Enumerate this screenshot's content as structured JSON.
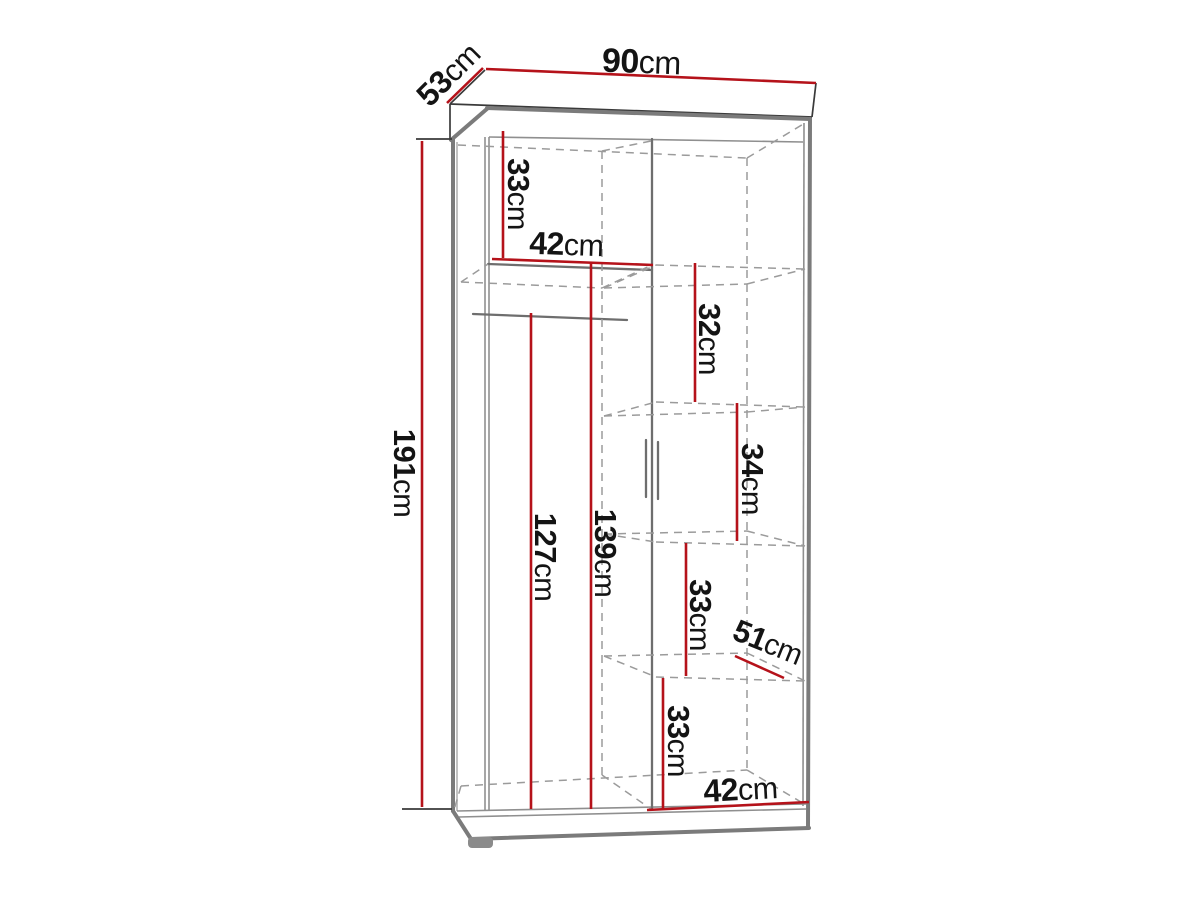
{
  "diagram": {
    "type": "furniture-dimension-drawing",
    "subject": "two-door wardrobe with left hanging section and right shelf column",
    "unit": "cm",
    "colors": {
      "dimension_red": "#b5121a",
      "outline_gray": "#7b7b7b",
      "hidden_edge_gray": "#9b9b9b",
      "label_black": "#141414",
      "background": "#ffffff"
    },
    "dimensions": {
      "width_top": {
        "value": "90",
        "unit": "cm",
        "line": {
          "x1": 486,
          "y1": 69,
          "x2": 816,
          "y2": 83
        },
        "label": {
          "x": 641,
          "y": 73,
          "rot": 2,
          "size": 34
        }
      },
      "depth_top": {
        "value": "53",
        "unit": "cm",
        "line": {
          "x1": 447,
          "y1": 103,
          "x2": 483,
          "y2": 68
        },
        "label": {
          "x": 456,
          "y": 82,
          "rot": -45,
          "size": 32
        }
      },
      "height_left": {
        "value": "191",
        "unit": "cm",
        "line": {
          "x1": 422,
          "y1": 141,
          "x2": 422,
          "y2": 807
        },
        "label": {
          "x": 394,
          "y": 473,
          "rot": 90,
          "size": 31
        }
      },
      "top_section_height": {
        "value": "33",
        "unit": "cm",
        "line": {
          "x1": 503,
          "y1": 131,
          "x2": 503,
          "y2": 258
        },
        "label": {
          "x": 508,
          "y": 194,
          "rot": 90,
          "size": 31
        }
      },
      "shelf_width_top": {
        "value": "42",
        "unit": "cm",
        "line": {
          "x1": 492,
          "y1": 259,
          "x2": 653,
          "y2": 265
        },
        "label": {
          "x": 566,
          "y": 255,
          "rot": 2,
          "size": 32
        }
      },
      "rail_to_floor": {
        "value": "127",
        "unit": "cm",
        "line": {
          "x1": 531,
          "y1": 313,
          "x2": 531,
          "y2": 809
        },
        "label": {
          "x": 535,
          "y": 557,
          "rot": 90,
          "size": 31
        }
      },
      "left_section_height": {
        "value": "139",
        "unit": "cm",
        "line": {
          "x1": 591,
          "y1": 262,
          "x2": 591,
          "y2": 809
        },
        "label": {
          "x": 595,
          "y": 553,
          "rot": 90,
          "size": 31
        }
      },
      "right_section_1": {
        "value": "32",
        "unit": "cm",
        "line": {
          "x1": 695,
          "y1": 263,
          "x2": 695,
          "y2": 402
        },
        "label": {
          "x": 699,
          "y": 339,
          "rot": 90,
          "size": 31
        }
      },
      "right_section_2": {
        "value": "34",
        "unit": "cm",
        "line": {
          "x1": 737,
          "y1": 403,
          "x2": 737,
          "y2": 541
        },
        "label": {
          "x": 742,
          "y": 479,
          "rot": 90,
          "size": 31
        }
      },
      "right_section_3": {
        "value": "33",
        "unit": "cm",
        "line": {
          "x1": 686,
          "y1": 543,
          "x2": 686,
          "y2": 676
        },
        "label": {
          "x": 690,
          "y": 615,
          "rot": 90,
          "size": 31
        }
      },
      "right_section_4": {
        "value": "33",
        "unit": "cm",
        "line": {
          "x1": 663,
          "y1": 678,
          "x2": 663,
          "y2": 808
        },
        "label": {
          "x": 668,
          "y": 741,
          "rot": 90,
          "size": 31
        }
      },
      "shelf_depth": {
        "value": "51",
        "unit": "cm",
        "line": {
          "x1": 735,
          "y1": 656,
          "x2": 784,
          "y2": 678
        },
        "label": {
          "x": 764,
          "y": 652,
          "rot": 22,
          "size": 31
        }
      },
      "bottom_width": {
        "value": "42",
        "unit": "cm",
        "line": {
          "x1": 647,
          "y1": 810,
          "x2": 809,
          "y2": 802
        },
        "label": {
          "x": 741,
          "y": 800,
          "rot": -3,
          "size": 32
        }
      }
    }
  }
}
